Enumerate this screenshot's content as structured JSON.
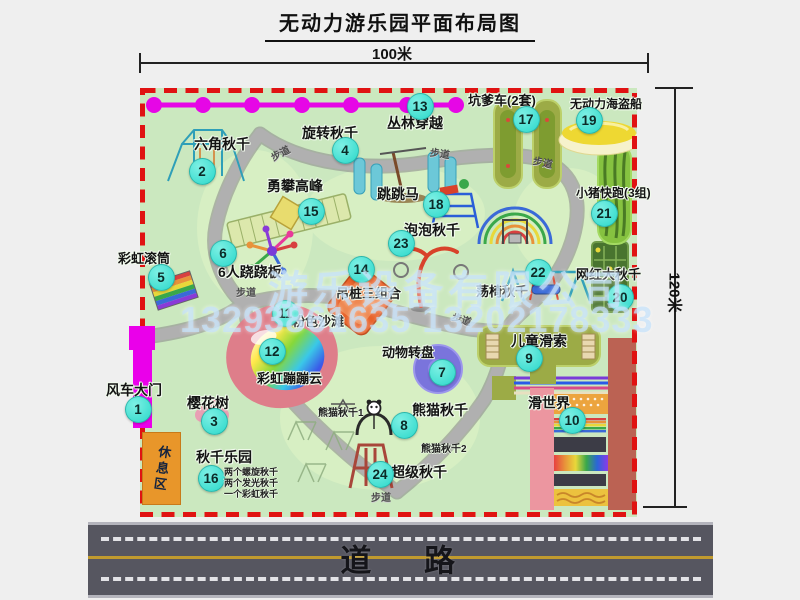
{
  "title": "无动力游乐园平面布局图",
  "dimensions": {
    "width_label": "100米",
    "height_label": "120米"
  },
  "watermark": {
    "company": "游乐设备有限公司",
    "phones": "13293861635 13202178333"
  },
  "rest_area_label": "休息区",
  "road_label": "道 路",
  "path_label": "步道",
  "colors": {
    "map_green": "#cbe8bf",
    "border_red": "#e01212",
    "badge_cyan": "#3ee6d6",
    "gate_magenta": "#ea00ea",
    "zipline_magenta": "#e606e6",
    "rest_orange": "#e8962a",
    "road_gray": "#565660",
    "path_gray": "#b0b0b0"
  },
  "attractions": [
    {
      "id": "1",
      "name": "风车大门",
      "icon": "windmill-gate",
      "bx": 137,
      "by": 408,
      "lx": 106,
      "ly": 380,
      "fs": 14
    },
    {
      "id": "2",
      "name": "六角秋千",
      "icon": "hexagon-swing",
      "bx": 201,
      "by": 170,
      "lx": 194,
      "ly": 134,
      "fs": 14
    },
    {
      "id": "3",
      "name": "樱花树",
      "icon": "cherry-blossom-tree",
      "bx": 213,
      "by": 420,
      "lx": 187,
      "ly": 393,
      "fs": 14
    },
    {
      "id": "4",
      "name": "旋转秋千",
      "icon": "rotating-swing",
      "bx": 344,
      "by": 149,
      "lx": 302,
      "ly": 123,
      "fs": 14
    },
    {
      "id": "5",
      "name": "彩虹滚筒",
      "icon": "rainbow-roller",
      "bx": 160,
      "by": 276,
      "lx": 118,
      "ly": 248,
      "fs": 13
    },
    {
      "id": "6",
      "name": "6人跷跷板",
      "icon": "six-seat-seesaw",
      "bx": 222,
      "by": 252,
      "lx": 218,
      "ly": 262,
      "fs": 14
    },
    {
      "id": "7",
      "name": "动物转盘",
      "icon": "animal-turntable",
      "bx": 441,
      "by": 371,
      "lx": 382,
      "ly": 342,
      "fs": 13
    },
    {
      "id": "8",
      "name": "熊猫秋千",
      "icon": "panda-swing",
      "bx": 403,
      "by": 424,
      "lx": 412,
      "ly": 400,
      "fs": 14
    },
    {
      "id": "9",
      "name": "儿童滑索",
      "icon": "kids-zipline",
      "bx": 528,
      "by": 357,
      "lx": 511,
      "ly": 331,
      "fs": 14
    },
    {
      "id": "10",
      "name": "滑世界",
      "icon": "slide-world",
      "bx": 571,
      "by": 419,
      "lx": 528,
      "ly": 393,
      "fs": 14
    },
    {
      "id": "11",
      "name": "粉色沙滩",
      "icon": "pink-beach",
      "bx": 284,
      "by": 312,
      "lx": 292,
      "ly": 311,
      "fs": 13
    },
    {
      "id": "12",
      "name": "彩虹蹦蹦云",
      "icon": "rainbow-bounce-cloud",
      "bx": 271,
      "by": 350,
      "lx": 257,
      "ly": 368,
      "fs": 13
    },
    {
      "id": "13",
      "name": "丛林穿越",
      "icon": "jungle-crossing-zipline",
      "bx": 419,
      "by": 105,
      "lx": 387,
      "ly": 113,
      "fs": 14
    },
    {
      "id": "14",
      "name": "吊桩三组合",
      "icon": "hanging-piles-combo",
      "bx": 360,
      "by": 268,
      "lx": 336,
      "ly": 283,
      "fs": 13
    },
    {
      "id": "15",
      "name": "勇攀高峰",
      "icon": "climbing-wall",
      "bx": 310,
      "by": 210,
      "lx": 267,
      "ly": 176,
      "fs": 14
    },
    {
      "id": "16",
      "name": "秋千乐园",
      "icon": "swing-paradise",
      "bx": 210,
      "by": 477,
      "lx": 196,
      "ly": 447,
      "fs": 14
    },
    {
      "id": "17",
      "name": "坑爹车(2套)",
      "icon": "pit-cars",
      "bx": 525,
      "by": 118,
      "lx": 468,
      "ly": 90,
      "fs": 13
    },
    {
      "id": "18",
      "name": "跳跳马",
      "icon": "jumping-horse",
      "bx": 435,
      "by": 203,
      "lx": 377,
      "ly": 184,
      "fs": 14
    },
    {
      "id": "19",
      "name": "无动力海盗船",
      "icon": "pirate-ship",
      "bx": 588,
      "by": 119,
      "lx": 570,
      "ly": 95,
      "fs": 12
    },
    {
      "id": "20",
      "name": "网红大秋千",
      "icon": "big-net-swing",
      "bx": 619,
      "by": 296,
      "lx": 576,
      "ly": 264,
      "fs": 13
    },
    {
      "id": "21",
      "name": "小猪快跑(3组)",
      "icon": "pig-run-track",
      "bx": 603,
      "by": 212,
      "lx": 576,
      "ly": 184,
      "fs": 12
    },
    {
      "id": "22",
      "name": "荡椅秋千",
      "icon": "chair-swing",
      "bx": 537,
      "by": 271,
      "lx": 476,
      "ly": 281,
      "fs": 13
    },
    {
      "id": "23",
      "name": "泡泡秋千",
      "icon": "bubble-swing",
      "bx": 400,
      "by": 242,
      "lx": 404,
      "ly": 220,
      "fs": 14
    },
    {
      "id": "24",
      "name": "超级秋千",
      "icon": "super-swing",
      "bx": 379,
      "by": 473,
      "lx": 391,
      "ly": 462,
      "fs": 14
    }
  ],
  "notes": [
    {
      "text": "熊猫秋千1",
      "x": 318,
      "y": 404,
      "fs": 10
    },
    {
      "text": "熊猫秋千2",
      "x": 421,
      "y": 440,
      "fs": 10
    },
    {
      "text": "两个螺旋秋千",
      "x": 224,
      "y": 465,
      "fs": 9
    },
    {
      "text": "两个发光秋千",
      "x": 224,
      "y": 476,
      "fs": 9
    },
    {
      "text": "一个彩虹秋千",
      "x": 224,
      "y": 487,
      "fs": 9
    }
  ],
  "path_label_positions": [
    {
      "x": 270,
      "y": 145,
      "rot": -28
    },
    {
      "x": 430,
      "y": 145,
      "rot": 8
    },
    {
      "x": 533,
      "y": 154,
      "rot": 12
    },
    {
      "x": 236,
      "y": 284,
      "rot": 0
    },
    {
      "x": 452,
      "y": 311,
      "rot": 18
    },
    {
      "x": 371,
      "y": 489,
      "rot": 0
    }
  ]
}
